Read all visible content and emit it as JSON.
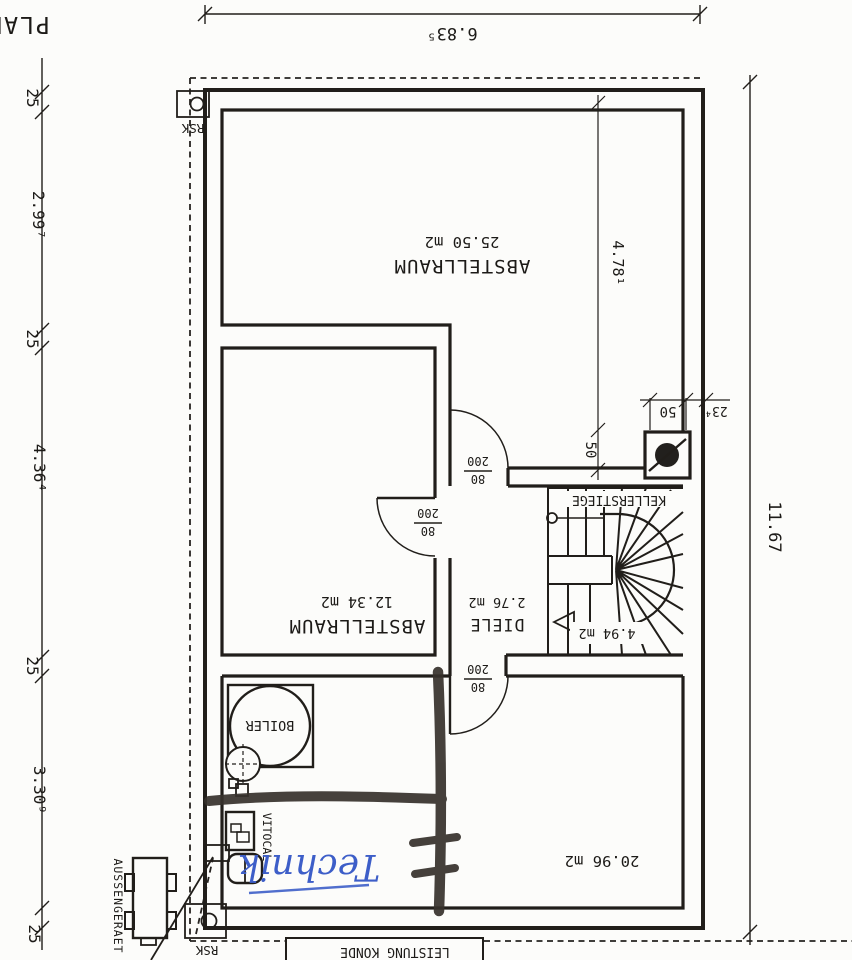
{
  "plan": {
    "title_fragment": "PLAN",
    "colors": {
      "ink": "#211e1a",
      "marker": "#36312b",
      "handwriting_blue": "#3d5ec8",
      "paper": "#fcfcfa"
    },
    "dimensions": {
      "top_width": "6.83⁵",
      "right_height": "11.67",
      "left_chain": [
        "25",
        "2.99⁷",
        "25",
        "4.36⁴",
        "25",
        "3.30⁹",
        "25"
      ],
      "interior_height": "4.78¹",
      "chimney_depth": "50",
      "chimney_width": "50",
      "right_offset": "23⁴"
    },
    "rooms": {
      "storage_large": {
        "name": "ABSTELLRAUM",
        "area": "25.50 m2"
      },
      "storage_small": {
        "name": "ABSTELLRAUM",
        "area": "12.34 m2"
      },
      "hall": {
        "name": "DIELE",
        "area": "2.76 m2"
      },
      "stairs": {
        "name": "KELLERSTIEGE",
        "area": "4.94 m2"
      },
      "technik_room": {
        "area": "20.96 m2"
      }
    },
    "door_label": {
      "width": "80",
      "height": "200"
    },
    "equipment": {
      "boiler": "BOILER",
      "heat_pump": "VITOCAL",
      "outdoor_unit": "AUSSENGERAET",
      "shutoff_box": "RSK"
    },
    "annotations": {
      "handwritten": "Technik",
      "bottom_box": "LEISTUNG KONDE"
    }
  }
}
